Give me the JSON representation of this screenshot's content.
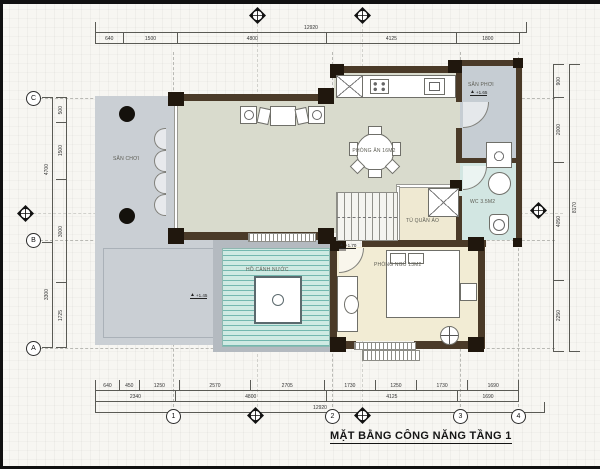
{
  "title": "MẶT BẰNG CÔNG NĂNG TẦNG 1",
  "rooms": {
    "playground": {
      "label": "SÂN CHƠI",
      "elevation": "+1.45"
    },
    "dining": {
      "label": "PHÒNG ĂN 16M2"
    },
    "drying_yard": {
      "label": "SÂN PHƠI",
      "elevation": "+1.65"
    },
    "wc": {
      "label": "WC 3.5M2"
    },
    "wardrobe": {
      "label": "TỦ QUẦN ÁO"
    },
    "bedroom": {
      "label": "PHÒNG NGỦ 13M2",
      "elevation": "+1.70"
    },
    "pond": {
      "label": "HỒ CẢNH NƯỚC"
    }
  },
  "grid": {
    "bottom": [
      "1",
      "2",
      "3",
      "4"
    ],
    "left": [
      "C",
      "B",
      "A"
    ]
  },
  "dims": {
    "top_overall": [
      "12920"
    ],
    "top": [
      "640",
      "1500",
      "4800",
      "4125",
      "1800"
    ],
    "bottom1": [
      "640",
      "450",
      "1250",
      "2570",
      "2705",
      "1730",
      "1250",
      "1730",
      "1690"
    ],
    "bottom2": [
      "2340",
      "4800",
      "4125",
      "1690"
    ],
    "bottom_overall": [
      "12920"
    ],
    "left_inner": [
      "500",
      "1500",
      "3000",
      "1725"
    ],
    "left_outer": [
      "4700",
      "3300"
    ],
    "right_inner": [
      "900",
      "2000",
      "4050",
      "2250"
    ],
    "right_outer": [
      "8170"
    ]
  },
  "icons": {
    "axis_marker": "diamond-crosshair-arrow"
  },
  "colors": {
    "wall": "#4a3a28",
    "column": "#20170d",
    "floor_main": "#d9dbcd",
    "floor_bedroom": "#f2ecd4",
    "floor_hall": "#efe9d2",
    "terrace": "#cacfd4",
    "drying_yard": "#c6cdd3",
    "wc": "#d2e6e2",
    "pool_water": "#cfeae3",
    "pool_line": "#2a8f85"
  }
}
